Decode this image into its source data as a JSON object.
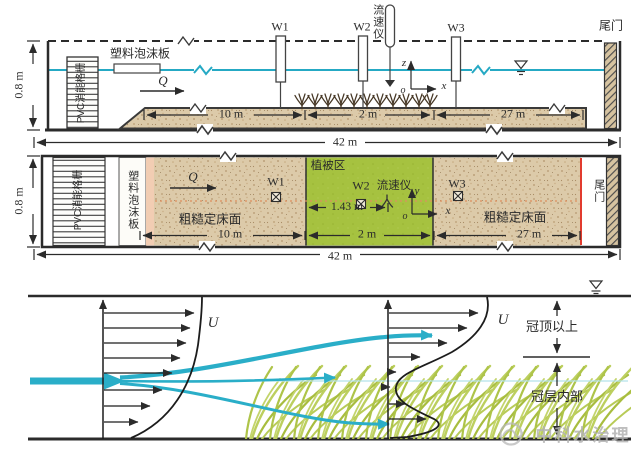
{
  "colors": {
    "water_line": "#25a9c4",
    "vegetation_zone": "#a6c240",
    "sand_bed": "#dccaa9",
    "tailgate_marker": "#e23b2e",
    "canopy_blades": "#b4c85a",
    "watermark_gray": "#b5b5b5"
  },
  "side_view": {
    "depth": "0.8 m",
    "energy_grid": "PVC消能格栅",
    "foam_board": "塑料泡沫板",
    "discharge": "Q",
    "wave_gauges": {
      "w1": "W1",
      "w2": "W2",
      "w3": "W3"
    },
    "velocimeter": "流速仪",
    "tail_gate": "尾门",
    "axes": {
      "z": "z",
      "x": "x",
      "origin": "o"
    },
    "dims": {
      "len10": "10 m",
      "len2": "2 m",
      "len27": "27 m",
      "total": "42 m"
    }
  },
  "plan_view": {
    "depth": "0.8 m",
    "energy_grid": "PVC消能格栅",
    "foam_board": "塑料泡沫板",
    "discharge": "Q",
    "vegetation_zone": "植被区",
    "wave_gauges": {
      "w1": "W1",
      "w2": "W2",
      "w3": "W3"
    },
    "velocimeter": "流速仪",
    "rough_bed_left": "粗糙定床面",
    "rough_bed_right": "粗糙定床面",
    "tail_gate": "尾门",
    "axes": {
      "y": "y",
      "x": "x",
      "origin": "o"
    },
    "dims": {
      "probe_offset": "1.43 m",
      "len10": "10 m",
      "len2": "2 m",
      "len27": "27 m",
      "total": "42 m"
    }
  },
  "profile_view": {
    "velocity_left": "U",
    "velocity_right": "U",
    "above_canopy": "冠顶以上",
    "inside_canopy": "冠层内部",
    "watermark": "中科水治理"
  }
}
